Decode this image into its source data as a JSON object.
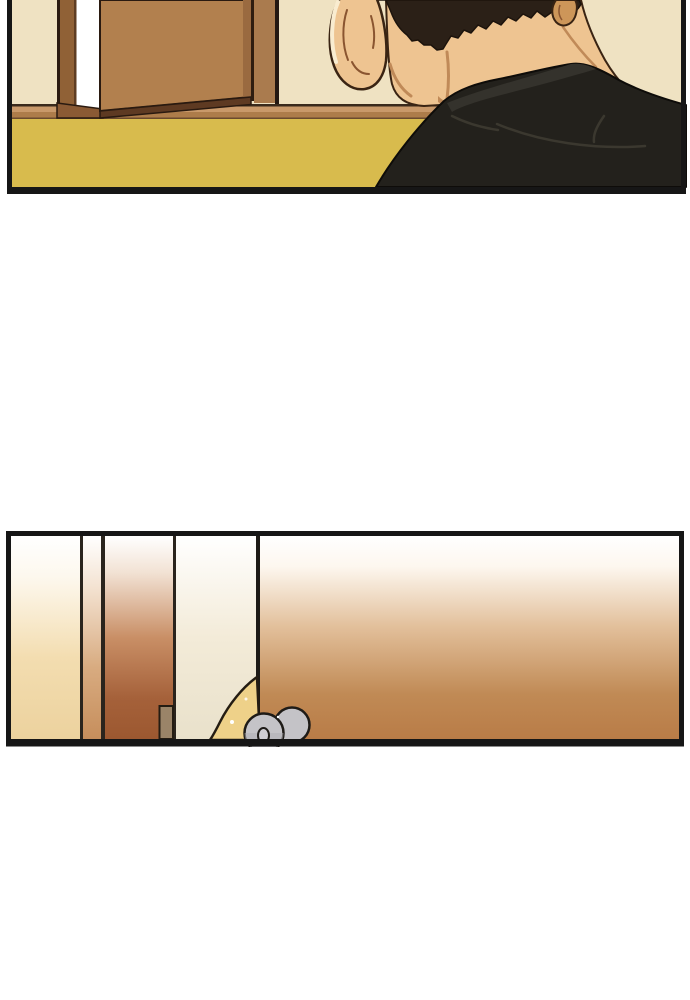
{
  "page": {
    "background": "#ffffff"
  },
  "panels": {
    "top": {
      "description": "Back view of a dark-haired man in a black jacket facing a partly open wooden door above a yellow baseboard wall"
    },
    "bottom": {
      "description": "Close-up of a door edge with a round grey metal doorknob and keyhole, drawn with vertical gradient strips"
    }
  },
  "palette": {
    "white": "#ffffff",
    "panel_border": "#161616",
    "wall": "#efe2c2",
    "ledge_line": "#3a2a1c",
    "ledge_top": "#c9996a",
    "ledge": "#ad7c4a",
    "ledge_underline": "#6b4a2e",
    "baseboard": "#d8bb4d",
    "frame_outline": "#2a1a10",
    "frame": "#906136",
    "frame_inner": "#5f3d22",
    "light_gap": "#ffffff",
    "sill": "#8a5a34",
    "door": "#b2804e",
    "door_shade": "#9a6a40",
    "door_bottom": "#5e3a22",
    "jamb_line": "#2f1d10",
    "jamb": "#aa7b4e",
    "jamb_edge": "#241812",
    "skin": "#eec491",
    "skin_shade": "#c08a58",
    "skin_outline": "#3a2413",
    "ear_highlight": "#f9ecd0",
    "ear_inner": "#8a5530",
    "ear_back": "#cd9659",
    "hair": "#2b2017",
    "hair_outline": "#1c130c",
    "jacket": "#23211c",
    "jacket_collar": "#34322c",
    "jacket_highlight": "#3b382f",
    "jacket_outline": "#0e0c09",
    "divider": "#2a241d",
    "door_edge_line": "#1d1a16",
    "stopper": "#9a8468",
    "outline_dark": "#241c12",
    "wedge": "#eed189",
    "knob": "#c4c3c7",
    "knob_shade": "#b0afb4",
    "knob_outline": "#1e1b17",
    "keyhole": "#cfced3",
    "g1_mid": "#f3ddb0",
    "g1_end": "#ecd29e",
    "g2_mid": "#d8ab80",
    "g2_end": "#c68e5c",
    "g3_mid": "#c98f66",
    "g3_late": "#a5613a",
    "g3_end": "#9c5830",
    "g4_mid": "#f3ebd8",
    "g4_end": "#e9e1cb",
    "g5_mid": "#e2bf9a",
    "g5_late": "#c08a55",
    "g5_end": "#b97c47"
  }
}
